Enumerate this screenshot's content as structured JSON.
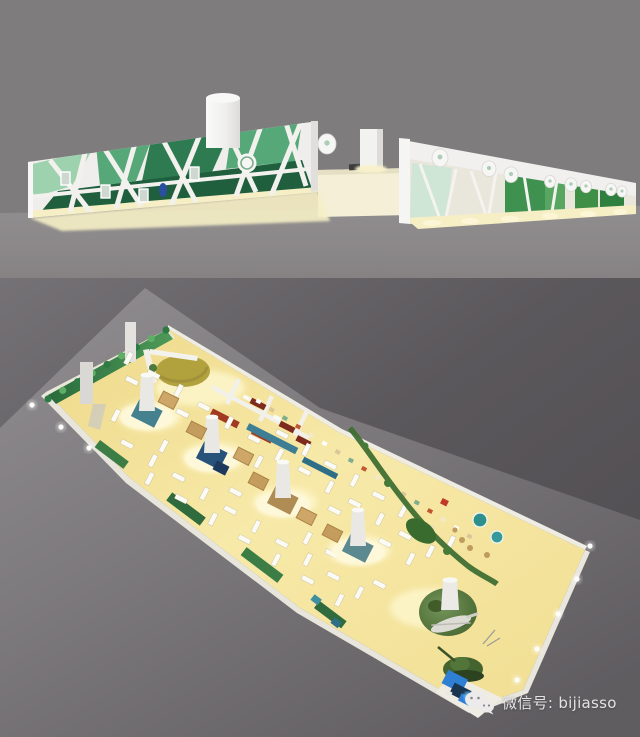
{
  "watermark": {
    "icon": "wechat-icon",
    "label": "微信号: bijiasso"
  },
  "panels": {
    "top": {
      "name": "exhibition-exterior-render"
    },
    "bottom": {
      "name": "exhibition-aerial-render"
    }
  },
  "colors": {
    "top_background": "#7f7c7d",
    "top_ground": "#8c898a",
    "wall_white": "#efeeec",
    "green_mint": "#9ed2ae",
    "green_mid": "#57a878",
    "green_dark": "#2e7a51",
    "green_bright": "#3f9150",
    "floor_cream": "#f6efc6",
    "bottom_background": "#535055",
    "bottom_ground": "#8e8b8e",
    "hall_floor": "#f3e093",
    "hedge_green": "#3e9456",
    "stage_olive": "#b1a23e",
    "sofa_red": "#7e2a1c",
    "panel_red": "#a23a22",
    "counter_teal": "#3d7e94",
    "machine_blue": "#2f7fd4",
    "watermark_text": "#e4e2e3"
  }
}
